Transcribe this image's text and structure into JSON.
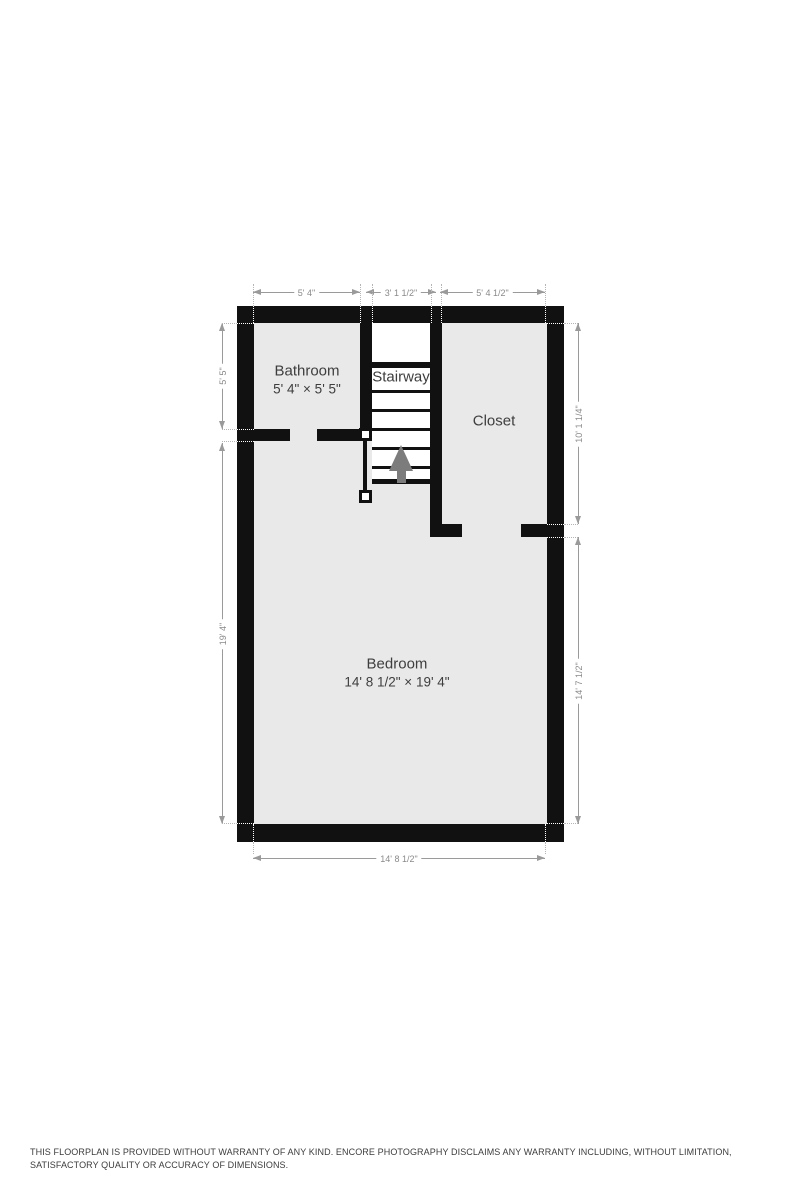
{
  "floorplan": {
    "rooms": {
      "bathroom": {
        "name": "Bathroom",
        "size": "5' 4\" × 5' 5\""
      },
      "stairway": {
        "name": "Stairway"
      },
      "closet": {
        "name": "Closet"
      },
      "bedroom": {
        "name": "Bedroom",
        "size": "14' 8 1/2\" × 19' 4\""
      }
    },
    "dimensions": {
      "top_left": "5' 4\"",
      "top_middle": "3' 1 1/2\"",
      "top_right": "5' 4 1/2\"",
      "left_upper": "5' 5\"",
      "left_lower": "19' 4\"",
      "right_upper": "10' 1 1/4\"",
      "right_lower": "14' 7 1/2\"",
      "bottom": "14' 8 1/2\""
    },
    "icons": {
      "stairs_direction": "up-arrow-icon"
    }
  },
  "colors": {
    "wall": "#111111",
    "room_fill": "#e9e9e9",
    "dimension": "#9a9a9a",
    "dim_text": "#8a8a8a",
    "room_label": "#3e3e3e",
    "stair_arrow": "#7c7c7c"
  },
  "footer": {
    "disclaimer": "THIS FLOORPLAN IS PROVIDED WITHOUT WARRANTY OF ANY KIND. ENCORE PHOTOGRAPHY DISCLAIMS ANY WARRANTY INCLUDING, WITHOUT LIMITATION, SATISFACTORY QUALITY OR ACCURACY OF DIMENSIONS."
  }
}
